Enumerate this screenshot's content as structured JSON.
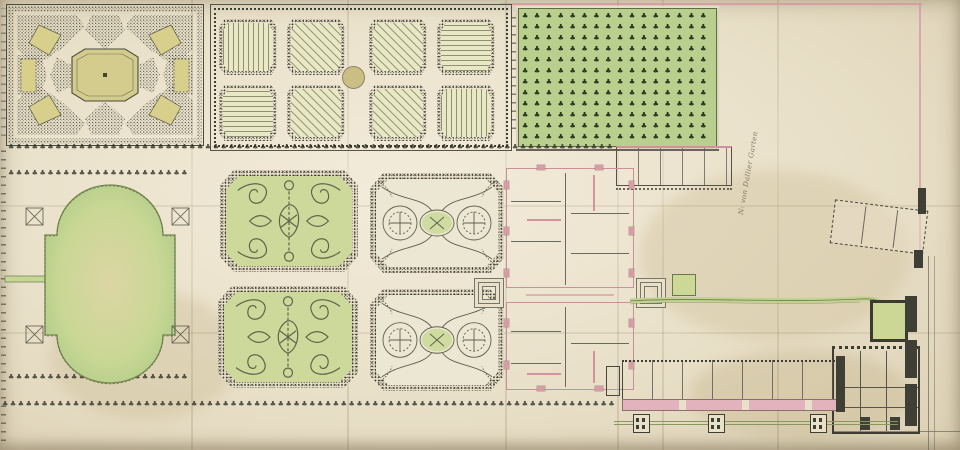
{
  "document": {
    "kind": "Hand-drawn baroque palace garden plan, pen and watercolor on aged paper",
    "handwritten_note": "N: von Dallier Garten"
  },
  "palette": {
    "paper": "#e9e0ca",
    "ink": "#34342a",
    "orchard_green": "#b9cf8e",
    "pond_green": "#bcd28f",
    "parterre_green": "#ccd99b",
    "bed_yellow": "#d6cd8a",
    "wall_pink": "#d79ba6",
    "boundary_pink": "#d493a0",
    "dark_wall": "#3f3f35"
  },
  "areas": {
    "bosquet_quarter": "north-west wilderness quarter, stippled shrubbery with central octagonal basin and six yellow beds",
    "kitchen_garden": {
      "beds": 8,
      "hatch_pattern": [
        "vertical",
        "diagonal",
        "diagonal",
        "horizontal",
        "horizontal",
        "diagonal",
        "diagonal",
        "vertical"
      ],
      "central_basin": "small round basin"
    },
    "orchard": {
      "rows": 12,
      "cols": 15,
      "description": "green orchard planted in a regular grid of trees"
    },
    "great_pond": "large oval pond with stepped middle section, four corner sluice marks and a canal to the west edge",
    "parterres": [
      "green scrollwork parterre NW",
      "broderie parterre NE",
      "green scrollwork parterre SW",
      "broderie parterre SE"
    ],
    "palace": "two-block corps de logis in pink wall outline with stepped porticos on both garden fronts",
    "east_canal": "narrow green channel from palace to a small square basin and a larger walled square basin",
    "outbuildings": "long service wing with pink corridor, slanted barn, dark-walled east courtyard block, three fence pavilions",
    "tree_allees": "rows of small tree symbols bordering the main walks"
  },
  "glyphs": {
    "tree": "♣",
    "orchard_grid": {
      "glyph": "♣",
      "count": 200
    },
    "row_top": {
      "glyph": "♣",
      "count": 90
    },
    "row_above_pond": {
      "glyph": "♣",
      "count": 28
    },
    "row_below_pond": {
      "glyph": "♣",
      "count": 28
    },
    "row_bottom": {
      "glyph": "♣",
      "count": 95
    }
  }
}
